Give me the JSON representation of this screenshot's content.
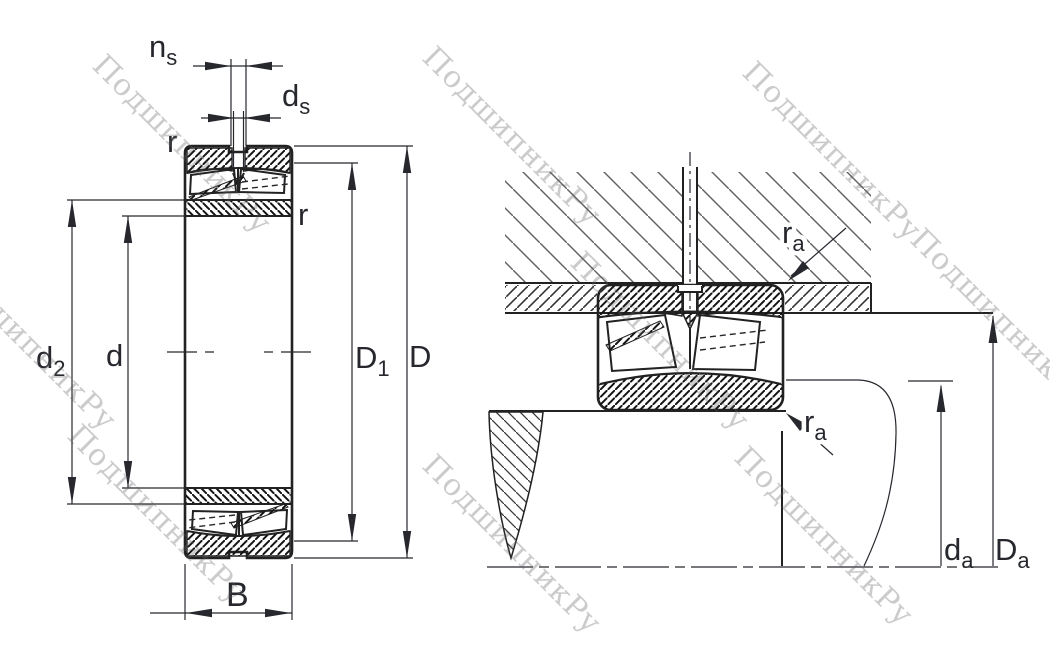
{
  "drawing": {
    "type": "bearing-technical-drawing",
    "views": {
      "left": "spherical-roller-bearing-cross-section",
      "right": "bearing-mounted-in-housing-on-shaft"
    }
  },
  "labels": {
    "ns": {
      "main": "n",
      "sub": "s"
    },
    "ds": {
      "main": "d",
      "sub": "s"
    },
    "r_outer": {
      "main": "r"
    },
    "r_inner": {
      "main": "r"
    },
    "d2": {
      "main": "d",
      "sub": "2"
    },
    "d": {
      "main": "d"
    },
    "D1": {
      "main": "D",
      "sub": "1"
    },
    "D": {
      "main": "D"
    },
    "B": {
      "main": "B"
    },
    "ra_housing": {
      "main": "r",
      "sub": "a"
    },
    "ra_shaft": {
      "main": "r",
      "sub": "a"
    },
    "da": {
      "main": "d",
      "sub": "a"
    },
    "Da": {
      "main": "D",
      "sub": "a"
    }
  },
  "watermark": {
    "text": "ПодшипникРу",
    "color": "#c9c9c9",
    "count": 9
  },
  "colors": {
    "line": "#222222",
    "label": "#26282e",
    "housing_hatch": "#606060",
    "background": "#ffffff"
  }
}
